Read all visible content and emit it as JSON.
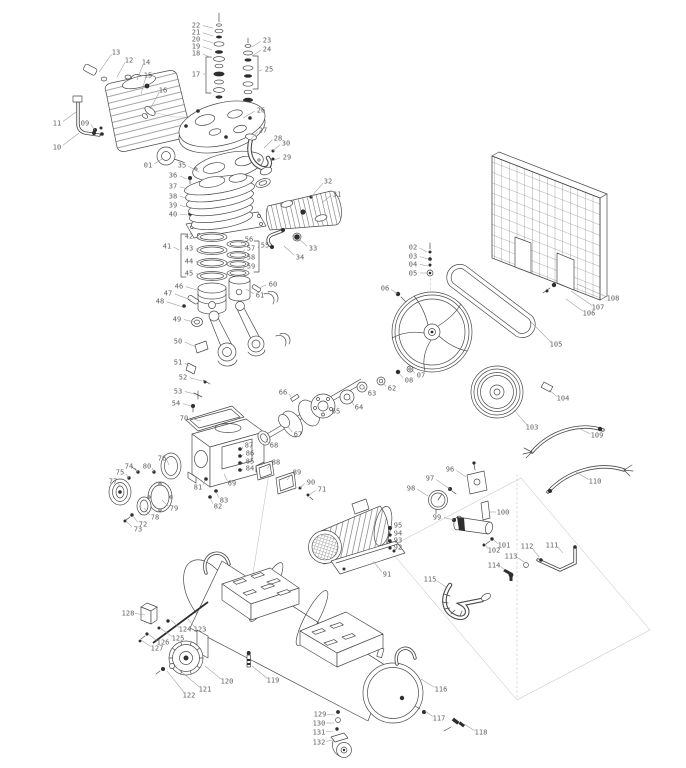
{
  "figure": {
    "kind": "exploded parts diagram",
    "subject": "belt-driven air compressor"
  },
  "style": {
    "background": "#ffffff",
    "line_color": "#4a4a4a",
    "label_color": "#5f5f5f",
    "leader_color": "#9a9a9a"
  },
  "callouts": [
    {
      "n": "01",
      "x": 148,
      "y": 165,
      "tx": 162,
      "ty": 159
    },
    {
      "n": "02",
      "x": 413,
      "y": 247,
      "tx": 427,
      "ty": 252
    },
    {
      "n": "03",
      "x": 413,
      "y": 256,
      "tx": 428,
      "ty": 259
    },
    {
      "n": "04",
      "x": 413,
      "y": 264,
      "tx": 428,
      "ty": 266
    },
    {
      "n": "05",
      "x": 413,
      "y": 273,
      "tx": 427,
      "ty": 273
    },
    {
      "n": "06",
      "x": 385,
      "y": 288,
      "tx": 397,
      "ty": 294
    },
    {
      "n": "07",
      "x": 421,
      "y": 375,
      "tx": 411,
      "ty": 369
    },
    {
      "n": "08",
      "x": 409,
      "y": 380,
      "tx": 399,
      "ty": 373
    },
    {
      "n": "09",
      "x": 85,
      "y": 123,
      "tx": 95,
      "ty": 130
    },
    {
      "n": "10",
      "x": 57,
      "y": 147,
      "tx": 79,
      "ty": 133
    },
    {
      "n": "11",
      "x": 57,
      "y": 123,
      "tx": 76,
      "ty": 112
    },
    {
      "n": "12",
      "x": 129,
      "y": 60,
      "tx": 117,
      "ty": 77
    },
    {
      "n": "13",
      "x": 116,
      "y": 52,
      "tx": 99,
      "ty": 72
    },
    {
      "n": "14",
      "x": 146,
      "y": 62,
      "tx": 137,
      "ty": 80
    },
    {
      "n": "15",
      "x": 148,
      "y": 75,
      "tx": 141,
      "ty": 94
    },
    {
      "n": "16",
      "x": 163,
      "y": 90,
      "tx": 150,
      "ty": 109
    },
    {
      "n": "17",
      "x": 196,
      "y": 74,
      "tx": 205,
      "ty": 74
    },
    {
      "n": "18",
      "x": 196,
      "y": 53,
      "tx": 212,
      "ty": 58
    },
    {
      "n": "19",
      "x": 196,
      "y": 46,
      "tx": 212,
      "ty": 50
    },
    {
      "n": "20",
      "x": 196,
      "y": 39,
      "tx": 213,
      "ty": 43
    },
    {
      "n": "21",
      "x": 196,
      "y": 32,
      "tx": 213,
      "ty": 36
    },
    {
      "n": "22",
      "x": 196,
      "y": 25,
      "tx": 213,
      "ty": 28
    },
    {
      "n": "23",
      "x": 267,
      "y": 40,
      "tx": 252,
      "ty": 47
    },
    {
      "n": "24",
      "x": 267,
      "y": 49,
      "tx": 252,
      "ty": 56
    },
    {
      "n": "25",
      "x": 269,
      "y": 69,
      "tx": 259,
      "ty": 71
    },
    {
      "n": "26",
      "x": 261,
      "y": 110,
      "tx": 243,
      "ty": 118
    },
    {
      "n": "27",
      "x": 263,
      "y": 130,
      "tx": 250,
      "ty": 140
    },
    {
      "n": "28",
      "x": 278,
      "y": 138,
      "tx": 264,
      "ty": 148
    },
    {
      "n": "29",
      "x": 287,
      "y": 157,
      "tx": 274,
      "ty": 160
    },
    {
      "n": "30",
      "x": 286,
      "y": 143,
      "tx": 273,
      "ty": 151
    },
    {
      "n": "31",
      "x": 337,
      "y": 194,
      "tx": 323,
      "ty": 202
    },
    {
      "n": "32",
      "x": 328,
      "y": 181,
      "tx": 311,
      "ty": 197
    },
    {
      "n": "33",
      "x": 313,
      "y": 248,
      "tx": 299,
      "ty": 239
    },
    {
      "n": "34",
      "x": 300,
      "y": 257,
      "tx": 284,
      "ty": 246
    },
    {
      "n": "35",
      "x": 182,
      "y": 165,
      "tx": 199,
      "ty": 172
    },
    {
      "n": "36",
      "x": 173,
      "y": 175,
      "tx": 187,
      "ty": 179
    },
    {
      "n": "37",
      "x": 173,
      "y": 186,
      "tx": 187,
      "ty": 189
    },
    {
      "n": "38",
      "x": 173,
      "y": 196,
      "tx": 187,
      "ty": 198
    },
    {
      "n": "39",
      "x": 173,
      "y": 205,
      "tx": 187,
      "ty": 207
    },
    {
      "n": "40",
      "x": 173,
      "y": 214,
      "tx": 187,
      "ty": 215
    },
    {
      "n": "41",
      "x": 167,
      "y": 246,
      "tx": 179,
      "ty": 250
    },
    {
      "n": "42",
      "x": 189,
      "y": 236,
      "tx": 202,
      "ty": 239
    },
    {
      "n": "43",
      "x": 189,
      "y": 248,
      "tx": 202,
      "ty": 251
    },
    {
      "n": "44",
      "x": 189,
      "y": 261,
      "tx": 202,
      "ty": 263
    },
    {
      "n": "45",
      "x": 189,
      "y": 273,
      "tx": 202,
      "ty": 275
    },
    {
      "n": "46",
      "x": 179,
      "y": 286,
      "tx": 197,
      "ty": 290
    },
    {
      "n": "47",
      "x": 168,
      "y": 293,
      "tx": 191,
      "ty": 300
    },
    {
      "n": "48",
      "x": 160,
      "y": 301,
      "tx": 183,
      "ty": 307
    },
    {
      "n": "49",
      "x": 177,
      "y": 319,
      "tx": 194,
      "ty": 322
    },
    {
      "n": "50",
      "x": 178,
      "y": 341,
      "tx": 196,
      "ty": 347
    },
    {
      "n": "51",
      "x": 178,
      "y": 362,
      "tx": 189,
      "ty": 366
    },
    {
      "n": "52",
      "x": 183,
      "y": 377,
      "tx": 202,
      "ty": 381
    },
    {
      "n": "53",
      "x": 178,
      "y": 391,
      "tx": 195,
      "ty": 394
    },
    {
      "n": "54",
      "x": 176,
      "y": 403,
      "tx": 191,
      "ty": 406
    },
    {
      "n": "55",
      "x": 265,
      "y": 245,
      "tx": 258,
      "ty": 248
    },
    {
      "n": "56",
      "x": 249,
      "y": 239,
      "tx": 241,
      "ty": 244
    },
    {
      "n": "57",
      "x": 251,
      "y": 248,
      "tx": 242,
      "ty": 253
    },
    {
      "n": "58",
      "x": 251,
      "y": 257,
      "tx": 242,
      "ty": 261
    },
    {
      "n": "59",
      "x": 251,
      "y": 266,
      "tx": 242,
      "ty": 270
    },
    {
      "n": "60",
      "x": 273,
      "y": 284,
      "tx": 259,
      "ty": 288
    },
    {
      "n": "61",
      "x": 260,
      "y": 295,
      "tx": 246,
      "ty": 289
    },
    {
      "n": "62",
      "x": 392,
      "y": 388,
      "tx": 382,
      "ty": 382
    },
    {
      "n": "63",
      "x": 372,
      "y": 393,
      "tx": 364,
      "ty": 388
    },
    {
      "n": "64",
      "x": 359,
      "y": 407,
      "tx": 350,
      "ty": 399
    },
    {
      "n": "65",
      "x": 336,
      "y": 411,
      "tx": 327,
      "ty": 406
    },
    {
      "n": "66",
      "x": 283,
      "y": 392,
      "tx": 292,
      "ty": 398
    },
    {
      "n": "67",
      "x": 298,
      "y": 434,
      "tx": 288,
      "ty": 427
    },
    {
      "n": "68",
      "x": 274,
      "y": 445,
      "tx": 266,
      "ty": 439
    },
    {
      "n": "69",
      "x": 232,
      "y": 483,
      "tx": 224,
      "ty": 474
    },
    {
      "n": "70",
      "x": 184,
      "y": 418,
      "tx": 201,
      "ty": 421
    },
    {
      "n": "71",
      "x": 322,
      "y": 489,
      "tx": 309,
      "ty": 495
    },
    {
      "n": "72",
      "x": 143,
      "y": 524,
      "tx": 133,
      "ty": 516
    },
    {
      "n": "73",
      "x": 138,
      "y": 529,
      "tx": 126,
      "ty": 521
    },
    {
      "n": "74",
      "x": 129,
      "y": 466,
      "tx": 138,
      "ty": 472
    },
    {
      "n": "75",
      "x": 120,
      "y": 472,
      "tx": 129,
      "ty": 478
    },
    {
      "n": "76",
      "x": 162,
      "y": 458,
      "tx": 169,
      "ty": 465
    },
    {
      "n": "77",
      "x": 113,
      "y": 481,
      "tx": 120,
      "ty": 487
    },
    {
      "n": "78",
      "x": 155,
      "y": 517,
      "tx": 144,
      "ty": 508
    },
    {
      "n": "79",
      "x": 174,
      "y": 508,
      "tx": 162,
      "ty": 500
    },
    {
      "n": "80",
      "x": 147,
      "y": 466,
      "tx": 154,
      "ty": 472
    },
    {
      "n": "81",
      "x": 198,
      "y": 487,
      "tx": 205,
      "ty": 480
    },
    {
      "n": "82",
      "x": 218,
      "y": 506,
      "tx": 210,
      "ty": 498
    },
    {
      "n": "83",
      "x": 224,
      "y": 500,
      "tx": 216,
      "ty": 492
    },
    {
      "n": "84",
      "x": 250,
      "y": 468,
      "tx": 242,
      "ty": 470
    },
    {
      "n": "85",
      "x": 250,
      "y": 461,
      "tx": 242,
      "ty": 463
    },
    {
      "n": "86",
      "x": 250,
      "y": 453,
      "tx": 242,
      "ty": 456
    },
    {
      "n": "87",
      "x": 249,
      "y": 445,
      "tx": 242,
      "ty": 449
    },
    {
      "n": "88",
      "x": 276,
      "y": 462,
      "tx": 267,
      "ty": 469
    },
    {
      "n": "89",
      "x": 297,
      "y": 472,
      "tx": 287,
      "ty": 480
    },
    {
      "n": "90",
      "x": 311,
      "y": 482,
      "tx": 300,
      "ty": 488
    },
    {
      "n": "91",
      "x": 387,
      "y": 574,
      "tx": 373,
      "ty": 561
    },
    {
      "n": "92",
      "x": 398,
      "y": 547,
      "tx": 392,
      "ty": 548
    },
    {
      "n": "93",
      "x": 398,
      "y": 540,
      "tx": 392,
      "ty": 541
    },
    {
      "n": "94",
      "x": 398,
      "y": 533,
      "tx": 392,
      "ty": 535
    },
    {
      "n": "95",
      "x": 398,
      "y": 525,
      "tx": 392,
      "ty": 528
    },
    {
      "n": "96",
      "x": 450,
      "y": 469,
      "tx": 466,
      "ty": 477
    },
    {
      "n": "97",
      "x": 430,
      "y": 478,
      "tx": 450,
      "ty": 489
    },
    {
      "n": "98",
      "x": 411,
      "y": 488,
      "tx": 428,
      "ty": 496
    },
    {
      "n": "99",
      "x": 437,
      "y": 517,
      "tx": 454,
      "ty": 520
    },
    {
      "n": "100",
      "x": 503,
      "y": 512,
      "tx": 489,
      "ty": 512
    },
    {
      "n": "101",
      "x": 504,
      "y": 545,
      "tx": 494,
      "ty": 540
    },
    {
      "n": "102",
      "x": 494,
      "y": 550,
      "tx": 485,
      "ty": 545
    },
    {
      "n": "103",
      "x": 532,
      "y": 427,
      "tx": 514,
      "ty": 410
    },
    {
      "n": "104",
      "x": 563,
      "y": 398,
      "tx": 549,
      "ty": 390
    },
    {
      "n": "105",
      "x": 556,
      "y": 344,
      "tx": 531,
      "ty": 322
    },
    {
      "n": "106",
      "x": 589,
      "y": 313,
      "tx": 566,
      "ty": 299
    },
    {
      "n": "107",
      "x": 598,
      "y": 307,
      "tx": 571,
      "ty": 291
    },
    {
      "n": "108",
      "x": 613,
      "y": 298,
      "tx": 577,
      "ty": 284
    },
    {
      "n": "109",
      "x": 597,
      "y": 435,
      "tx": 578,
      "ty": 428
    },
    {
      "n": "110",
      "x": 595,
      "y": 481,
      "tx": 576,
      "ty": 472
    },
    {
      "n": "111",
      "x": 552,
      "y": 545,
      "tx": 563,
      "ty": 553
    },
    {
      "n": "112",
      "x": 527,
      "y": 546,
      "tx": 539,
      "ty": 557
    },
    {
      "n": "113",
      "x": 511,
      "y": 556,
      "tx": 524,
      "ty": 562
    },
    {
      "n": "114",
      "x": 494,
      "y": 565,
      "tx": 505,
      "ty": 570
    },
    {
      "n": "115",
      "x": 430,
      "y": 579,
      "tx": 446,
      "ty": 587
    },
    {
      "n": "116",
      "x": 441,
      "y": 689,
      "tx": 421,
      "ty": 679
    },
    {
      "n": "117",
      "x": 439,
      "y": 718,
      "tx": 425,
      "ty": 711
    },
    {
      "n": "118",
      "x": 481,
      "y": 732,
      "tx": 464,
      "ty": 724
    },
    {
      "n": "119",
      "x": 273,
      "y": 680,
      "tx": 252,
      "ty": 666
    },
    {
      "n": "120",
      "x": 227,
      "y": 681,
      "tx": 205,
      "ty": 666
    },
    {
      "n": "121",
      "x": 205,
      "y": 689,
      "tx": 177,
      "ty": 668
    },
    {
      "n": "122",
      "x": 189,
      "y": 695,
      "tx": 167,
      "ty": 671
    },
    {
      "n": "123",
      "x": 200,
      "y": 629,
      "tx": 187,
      "ty": 618
    },
    {
      "n": "124",
      "x": 185,
      "y": 629,
      "tx": 171,
      "ty": 620
    },
    {
      "n": "125",
      "x": 178,
      "y": 638,
      "tx": 160,
      "ty": 628
    },
    {
      "n": "126",
      "x": 163,
      "y": 642,
      "tx": 148,
      "ty": 634
    },
    {
      "n": "127",
      "x": 157,
      "y": 648,
      "tx": 141,
      "ty": 640
    },
    {
      "n": "128",
      "x": 128,
      "y": 613,
      "tx": 145,
      "ty": 615
    },
    {
      "n": "129",
      "x": 320,
      "y": 714,
      "tx": 335,
      "ty": 715
    },
    {
      "n": "130",
      "x": 319,
      "y": 723,
      "tx": 334,
      "ty": 723
    },
    {
      "n": "131",
      "x": 319,
      "y": 732,
      "tx": 333,
      "ty": 731
    },
    {
      "n": "132",
      "x": 319,
      "y": 742,
      "tx": 332,
      "ty": 740
    }
  ]
}
